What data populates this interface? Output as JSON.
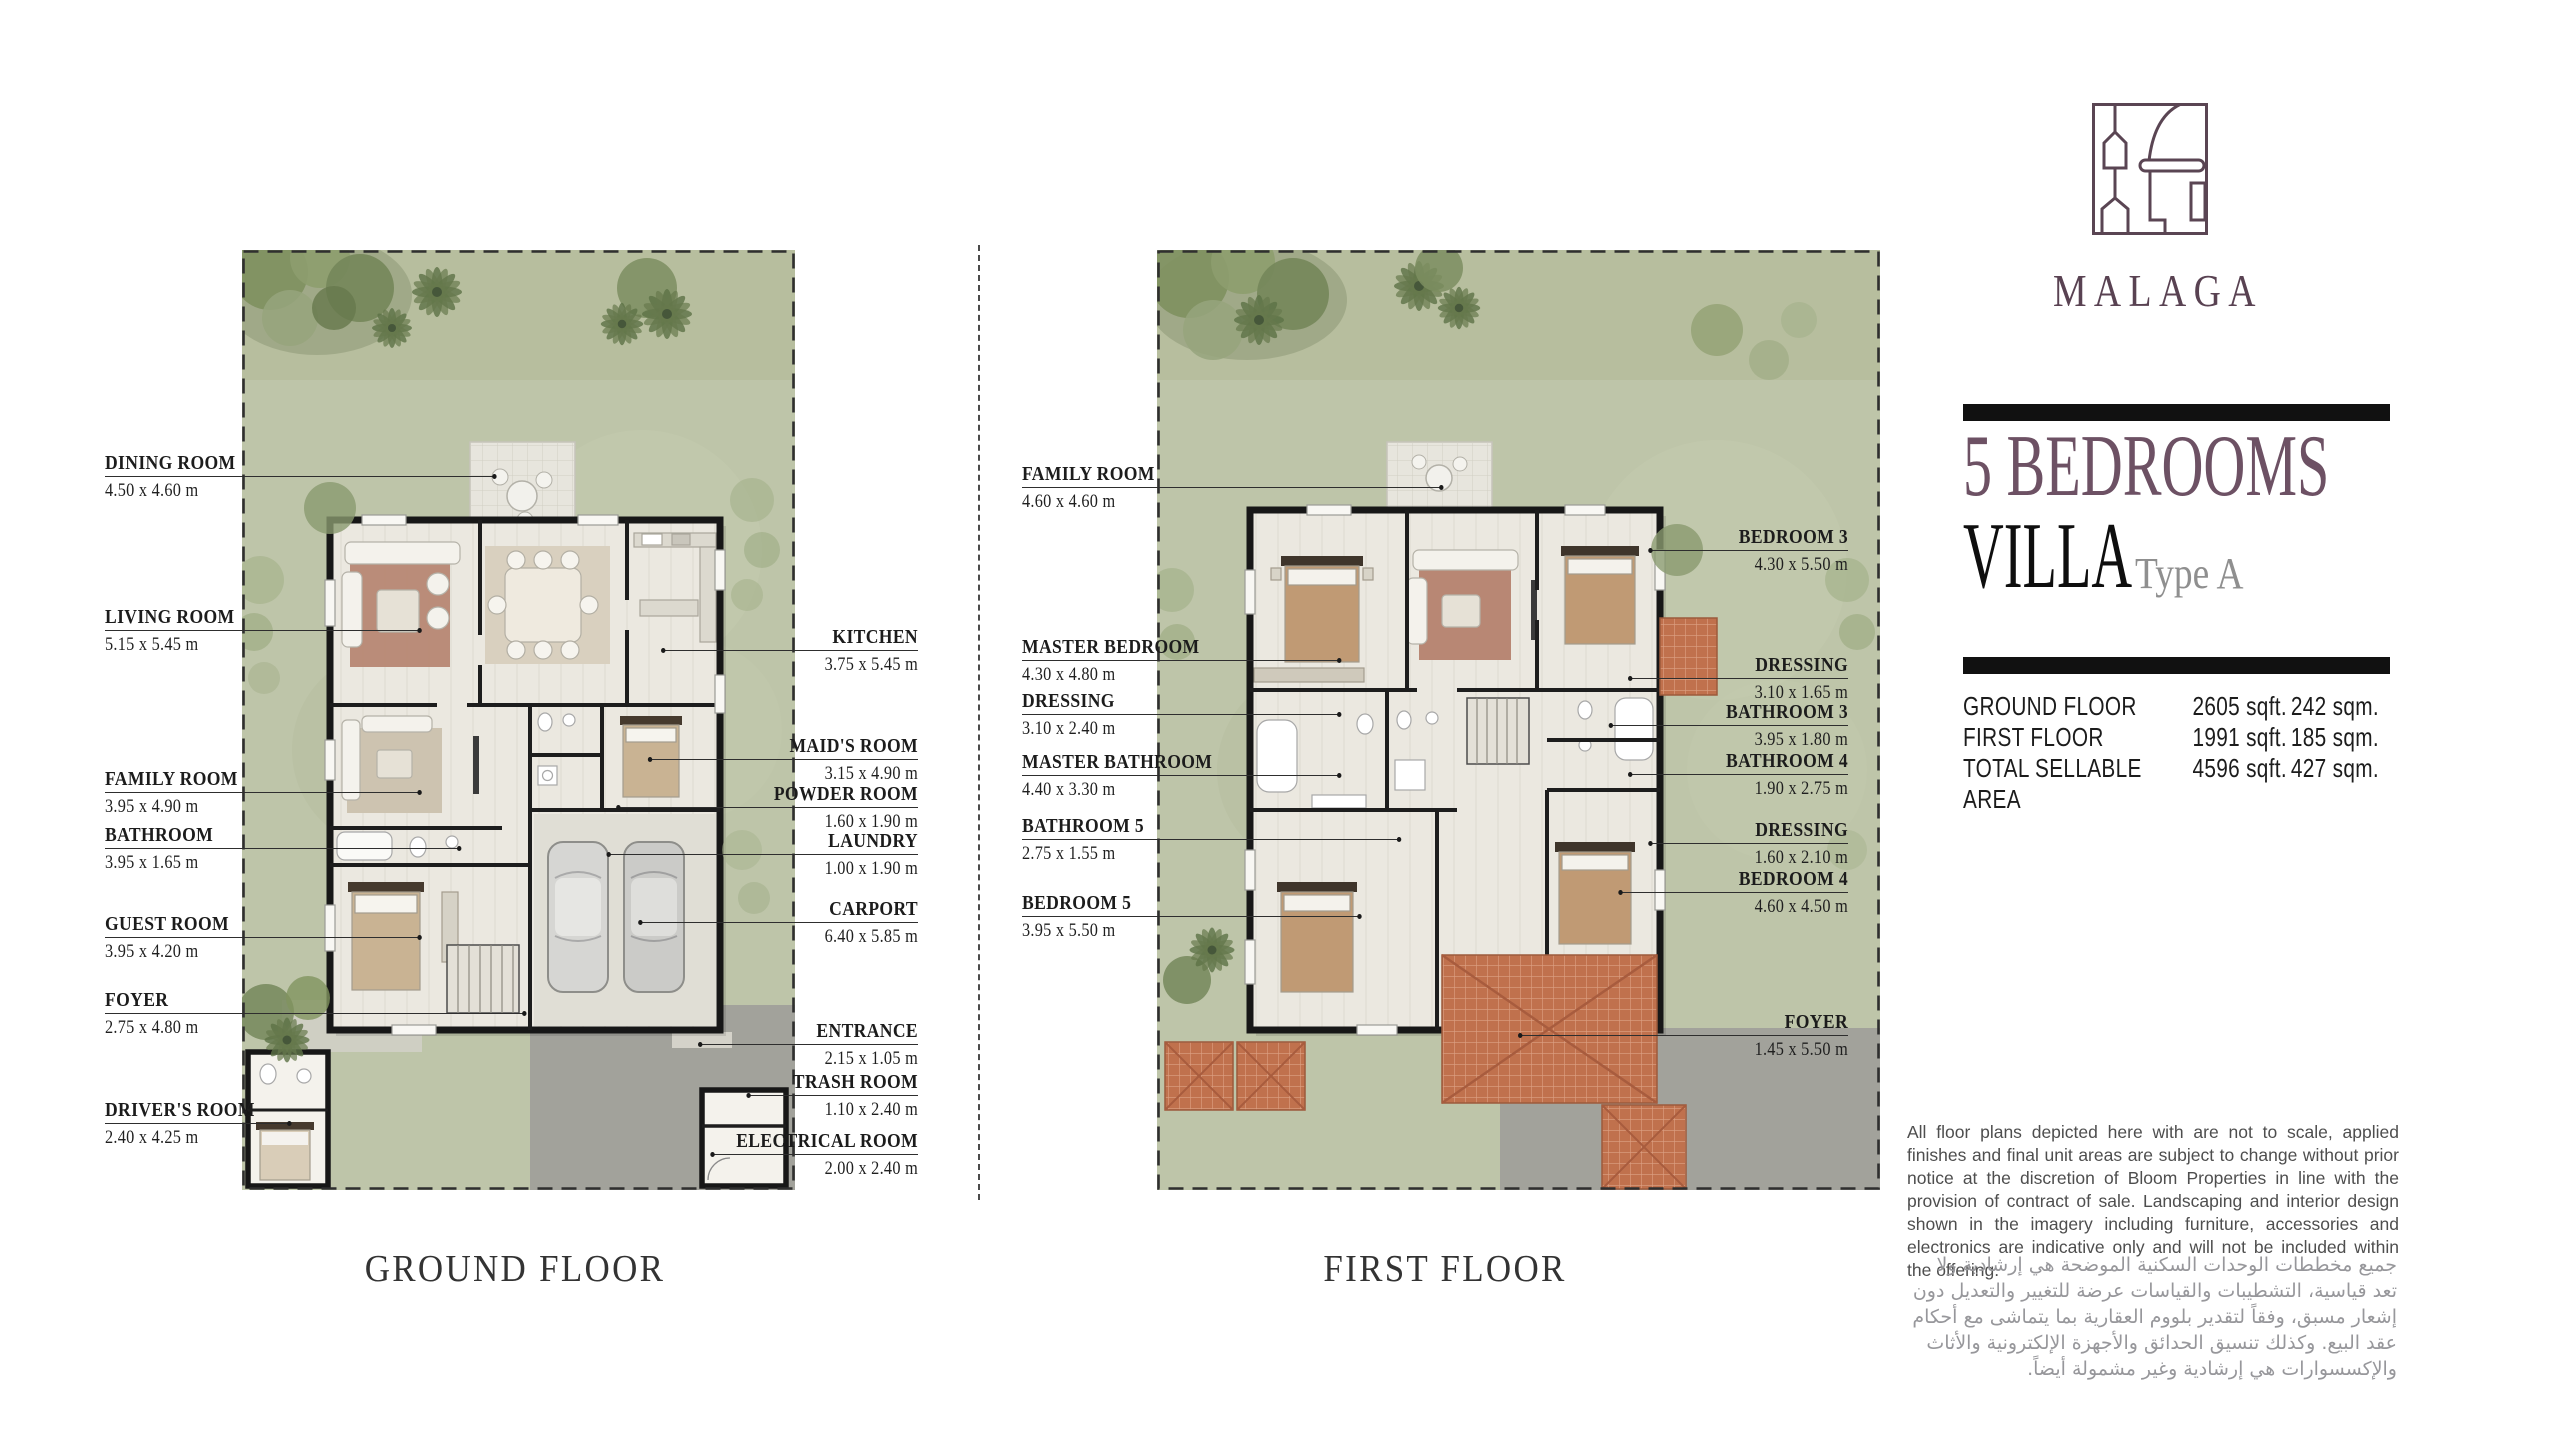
{
  "brand": {
    "name": "MALAGA"
  },
  "panel": {
    "bedrooms_line": "5 BEDROOMS",
    "villa_line": "VILLA",
    "type_label": "Type A",
    "area_rows": [
      {
        "label": "GROUND FLOOR",
        "sqft": "2605 sqft.",
        "sqm": "242 sqm."
      },
      {
        "label": "FIRST FLOOR",
        "sqft": "1991 sqft.",
        "sqm": "185 sqm."
      },
      {
        "label": "TOTAL SELLABLE AREA",
        "sqft": "4596 sqft.",
        "sqm": "427 sqm."
      }
    ],
    "disclaimer_en": "All floor plans depicted here with are not to scale, applied finishes and final unit areas are subject to change without prior notice at the discretion of Bloom Properties in line with the provision of contract of sale. Landscaping and interior design shown in the imagery including furniture, accessories and electronics are indicative only and will not be included within the offering.",
    "disclaimer_ar": "جميع مخططات الوحدات السكنية الموضحة هي إرشادية ولا تعد قياسية، التشطيبات والقياسات عرضة للتغيير والتعديل دون إشعار مسبق، وفقاً لتقدير بلووم العقارية بما يتماشى مع أحكام عقد البيع. وكذلك تنسيق الحدائق والأجهزة الإلكترونية والأثاث والإكسسوارات هي إرشادية وغير مشمولة أيضاً."
  },
  "ground_floor": {
    "caption": "GROUND FLOOR",
    "left_labels": [
      {
        "name": "DINING ROOM",
        "dims": "4.50 x 4.60 m"
      },
      {
        "name": "LIVING ROOM",
        "dims": "5.15 x 5.45 m"
      },
      {
        "name": "FAMILY ROOM",
        "dims": "3.95 x 4.90 m"
      },
      {
        "name": "BATHROOM",
        "dims": "3.95 x 1.65 m"
      },
      {
        "name": "GUEST ROOM",
        "dims": "3.95 x 4.20 m"
      },
      {
        "name": "FOYER",
        "dims": "2.75 x 4.80 m"
      },
      {
        "name": "DRIVER'S ROOM",
        "dims": "2.40 x 4.25 m"
      }
    ],
    "right_labels": [
      {
        "name": "KITCHEN",
        "dims": "3.75 x 5.45 m"
      },
      {
        "name": "MAID'S ROOM",
        "dims": "3.15 x 4.90 m"
      },
      {
        "name": "POWDER ROOM",
        "dims": "1.60 x 1.90 m"
      },
      {
        "name": "LAUNDRY",
        "dims": "1.00 x 1.90 m"
      },
      {
        "name": "CARPORT",
        "dims": "6.40 x 5.85 m"
      },
      {
        "name": "ENTRANCE",
        "dims": "2.15 x 1.05 m"
      },
      {
        "name": "TRASH ROOM",
        "dims": "1.10 x 2.40 m"
      },
      {
        "name": "ELECTRICAL ROOM",
        "dims": "2.00 x 2.40 m"
      }
    ]
  },
  "first_floor": {
    "caption": "FIRST FLOOR",
    "left_labels": [
      {
        "name": "FAMILY ROOM",
        "dims": "4.60 x 4.60 m"
      },
      {
        "name": "MASTER BEDROOM",
        "dims": "4.30 x 4.80 m"
      },
      {
        "name": "DRESSING",
        "dims": "3.10 x 2.40 m"
      },
      {
        "name": "MASTER BATHROOM",
        "dims": "4.40 x 3.30 m"
      },
      {
        "name": "BATHROOM 5",
        "dims": "2.75 x 1.55 m"
      },
      {
        "name": "BEDROOM 5",
        "dims": "3.95 x 5.50 m"
      }
    ],
    "right_labels": [
      {
        "name": "BEDROOM 3",
        "dims": "4.30 x 5.50 m"
      },
      {
        "name": "DRESSING",
        "dims": "3.10 x 1.65 m"
      },
      {
        "name": "BATHROOM 3",
        "dims": "3.95 x 1.80 m"
      },
      {
        "name": "BATHROOM 4",
        "dims": "1.90 x 2.75 m"
      },
      {
        "name": "DRESSING",
        "dims": "1.60 x 2.10 m"
      },
      {
        "name": "BEDROOM 4",
        "dims": "4.60 x 4.50 m"
      },
      {
        "name": "FOYER",
        "dims": "1.45 x 5.50 m"
      }
    ]
  },
  "colors": {
    "accent_plum": "#6d5164",
    "grass": "#bec5a9",
    "terracotta": "#c0714d",
    "wall": "#171717"
  }
}
